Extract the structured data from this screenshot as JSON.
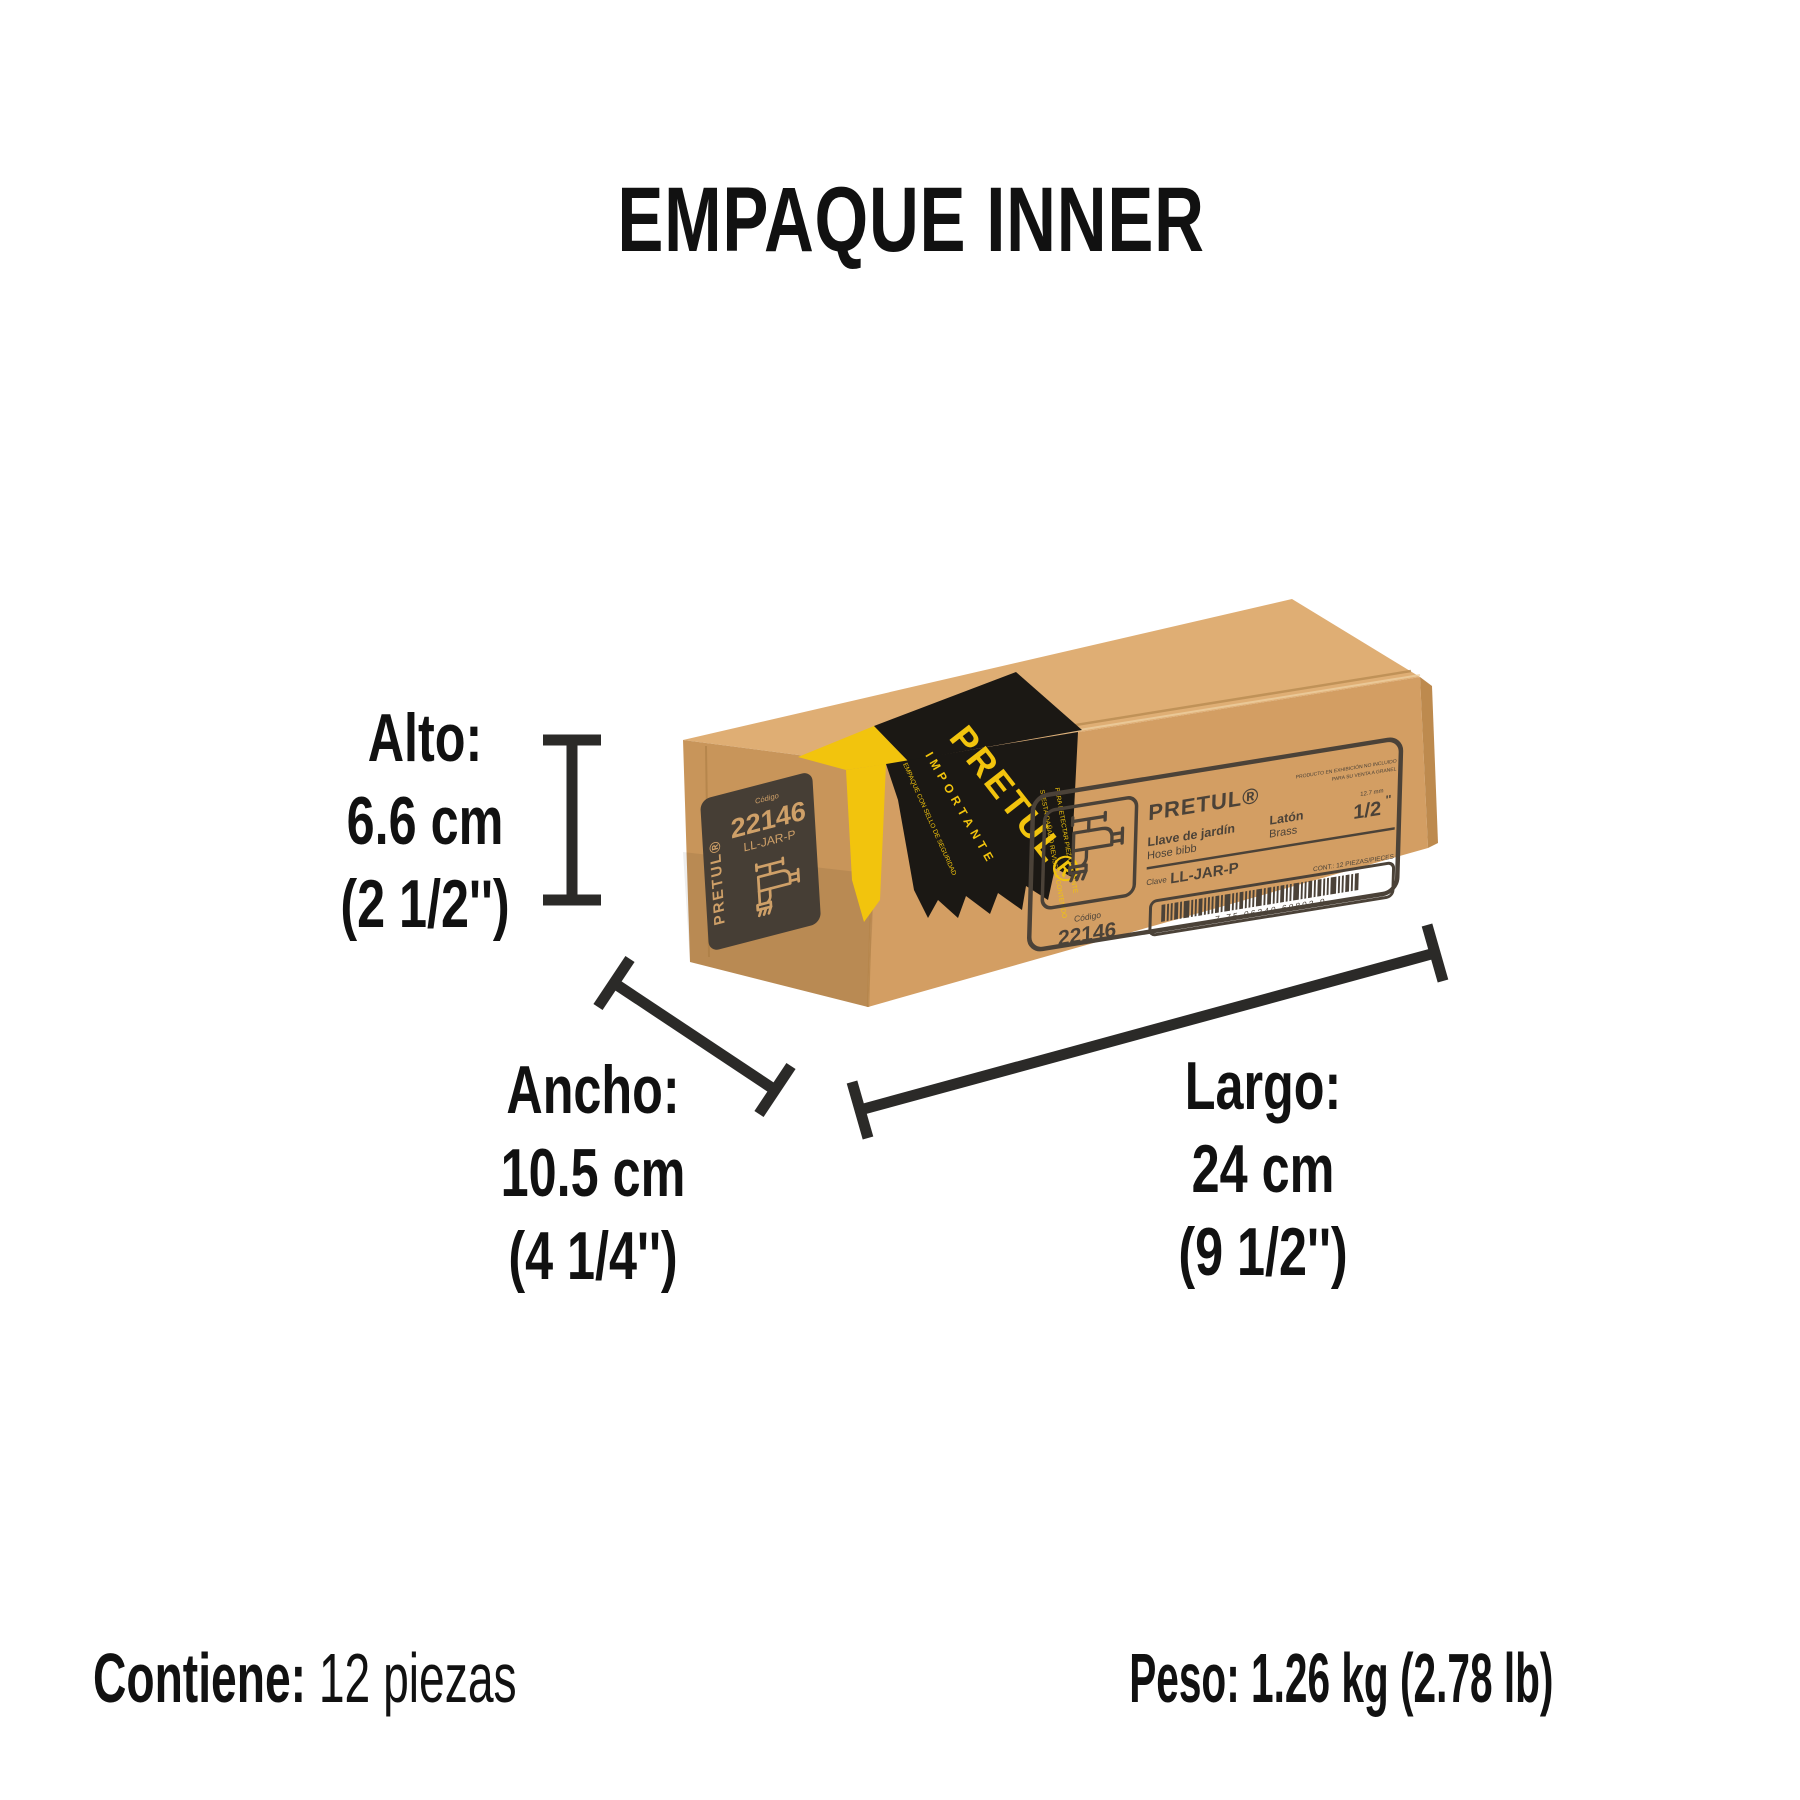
{
  "title": "EMPAQUE INNER",
  "colors": {
    "background": "#ffffff",
    "text": "#111111",
    "dimension_line": "#2b2a28",
    "box_top": "#dfae74",
    "box_front": "#d39e63",
    "box_left": "#c8955a",
    "box_sliver": "#bd8a4e",
    "ink": "#4b4238",
    "panel": "#463e35",
    "kraft_text": "#cfa068",
    "tape_black": "#1b1814",
    "tape_yellow": "#f2c40d"
  },
  "dimensions": {
    "alto": {
      "label": "Alto:",
      "metric": "6.6 cm",
      "imperial": "(2 1/2'')"
    },
    "ancho": {
      "label": "Ancho:",
      "metric": "10.5 cm",
      "imperial": "(4 1/4'')"
    },
    "largo": {
      "label": "Largo:",
      "metric": "24 cm",
      "imperial": "(9 1/2'')"
    }
  },
  "footer": {
    "contains_label": "Contiene:",
    "contains_value": "12 piezas",
    "weight_label": "Peso:",
    "weight_value": "1.26 kg (2.78 lb)"
  },
  "box": {
    "side_panel": {
      "brand": "PRETUL®",
      "codigo_label": "Código",
      "code": "22146",
      "sku": "LL-JAR-P"
    },
    "front_label": {
      "brand": "PRETUL®",
      "notice_line1": "PRODUCTO EN EXHIBICIÓN NO INCLUIDO",
      "notice_line2": "PARA SU VENTA A GRANEL",
      "product_es": "Llave de jardín",
      "product_en": "Hose bibb",
      "material_es": "Latón",
      "material_en": "Brass",
      "size_mm": "12.7 mm",
      "size": "1/2",
      "size_unit": "''",
      "clave_label": "Clave",
      "clave": "LL-JAR-P",
      "content": "CONT.: 12 PIEZAS/PIECES",
      "barcode_digits": "7 75 06240 60803 9",
      "codigo_label": "Código",
      "code": "22146"
    },
    "tape": {
      "brand": "PRETUL®",
      "warning": "IMPORTANTE",
      "line1": "EMPAQUE CON SELLO DE SEGURIDAD",
      "line2": "SI ESTÁ DAÑADO REVISE EL CONTENIDO",
      "line3": "PARA DETECTAR PIEZA FALTANTE"
    }
  }
}
